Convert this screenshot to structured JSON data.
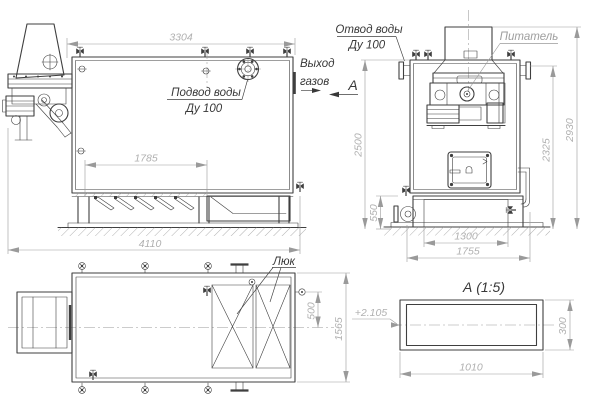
{
  "colors": {
    "bg": "#ffffff",
    "line": "#3f3f3f",
    "thin": "#9a9a9a",
    "dim_text": "#b0b0b0",
    "label_text": "#383838",
    "label_gray": "#9e9e9e"
  },
  "front_view": {
    "dim_top": "3304",
    "dim_grate": "1785",
    "dim_length": "4110",
    "water_inlet_line1": "Подвод воды",
    "water_inlet_line2": "Ду 100",
    "gas_out_line1": "Выход",
    "gas_out_line2": "газов",
    "section_mark": "А"
  },
  "side_view": {
    "water_outlet_line1": "Отвод воды",
    "water_outlet_line2": "Ду 100",
    "feeder_label": "Питатель",
    "dim_height_body": "2500",
    "dim_base_height": "550",
    "dim_base_inner": "1300",
    "dim_base_outer": "1755",
    "dim_height_flange": "2325",
    "dim_height_total": "2930"
  },
  "top_view": {
    "hatch_label": "Люк",
    "dim_offset": "500",
    "dim_depth": "1565"
  },
  "section_view": {
    "title": "А (1:5)",
    "elevation_mark": "+2.105",
    "dim_width": "1010",
    "dim_height": "300"
  }
}
